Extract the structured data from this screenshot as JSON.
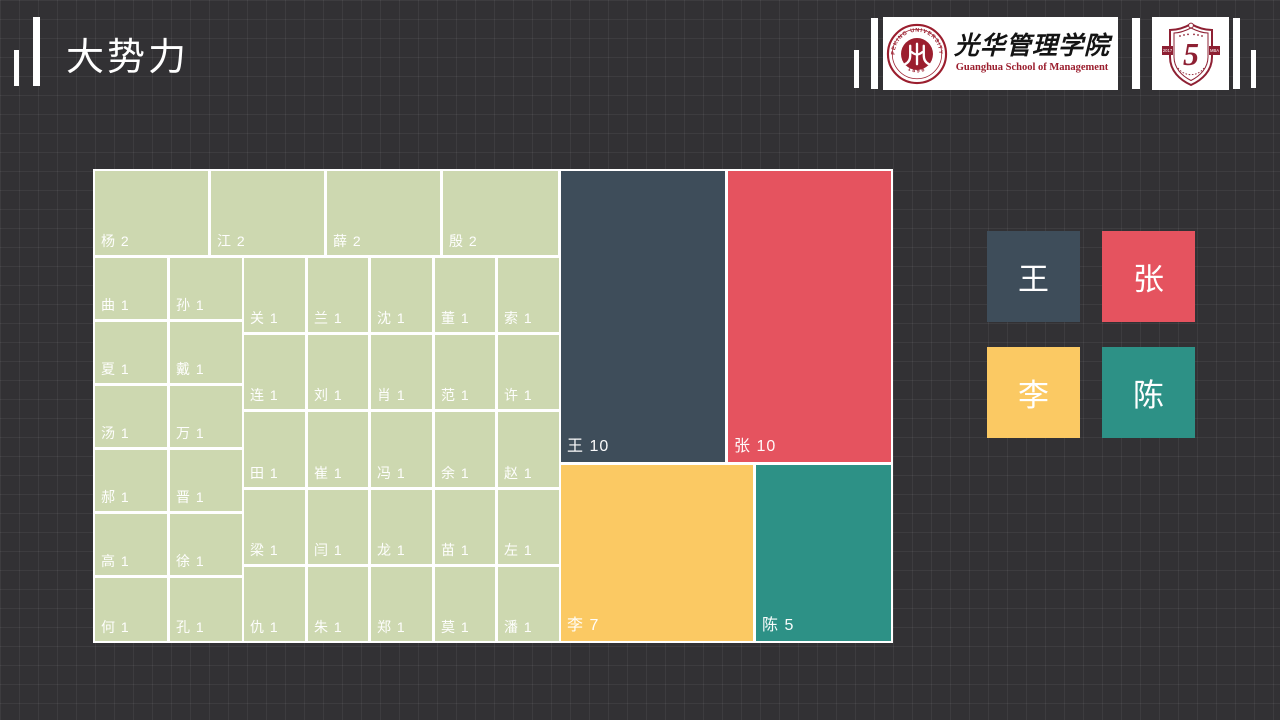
{
  "header": {
    "title": "大势力"
  },
  "logos": {
    "guanghua": {
      "name_cn": "光华管理学院",
      "name_en": "Guanghua School of Management",
      "seal_text_top": "PEKING UNIVERSITY",
      "seal_text_bottom": "1898"
    },
    "anniversary": {
      "number": "5",
      "year": "2017",
      "program": "MBA"
    }
  },
  "chart_data": {
    "type": "treemap",
    "title": "大势力",
    "description": "Surname frequency treemap; value = count of people per surname",
    "total": 77,
    "palette": {
      "green": "#cdd8b0",
      "dark": "#3e4d5a",
      "red": "#e5535f",
      "yellow": "#fbc963",
      "teal": "#2d9186"
    },
    "legend": [
      {
        "label": "王",
        "color": "dark"
      },
      {
        "label": "张",
        "color": "red"
      },
      {
        "label": "李",
        "color": "yellow"
      },
      {
        "label": "陈",
        "color": "teal"
      }
    ],
    "cells": [
      {
        "name": "王",
        "value": 10,
        "label": "王 10",
        "color": "dark",
        "x": 468,
        "y": 2,
        "w": 164,
        "h": 291
      },
      {
        "name": "张",
        "value": 10,
        "label": "张 10",
        "color": "red",
        "x": 635,
        "y": 2,
        "w": 163,
        "h": 291
      },
      {
        "name": "李",
        "value": 7,
        "label": "李 7",
        "color": "yellow",
        "x": 468,
        "y": 296,
        "w": 192,
        "h": 176
      },
      {
        "name": "陈",
        "value": 5,
        "label": "陈 5",
        "color": "teal",
        "x": 663,
        "y": 296,
        "w": 135,
        "h": 176
      },
      {
        "name": "杨",
        "value": 2,
        "label": "杨 2",
        "color": "green",
        "x": 2,
        "y": 2,
        "w": 113,
        "h": 84
      },
      {
        "name": "江",
        "value": 2,
        "label": "江 2",
        "color": "green",
        "x": 118,
        "y": 2,
        "w": 113,
        "h": 84
      },
      {
        "name": "薛",
        "value": 2,
        "label": "薛 2",
        "color": "green",
        "x": 234,
        "y": 2,
        "w": 113,
        "h": 84
      },
      {
        "name": "殷",
        "value": 2,
        "label": "殷 2",
        "color": "green",
        "x": 350,
        "y": 2,
        "w": 115,
        "h": 84
      },
      {
        "name": "曲",
        "value": 1,
        "label": "曲 1",
        "color": "green",
        "x": 2,
        "y": 89,
        "w": 72,
        "h": 61
      },
      {
        "name": "孙",
        "value": 1,
        "label": "孙 1",
        "color": "green",
        "x": 77,
        "y": 89,
        "w": 72,
        "h": 61
      },
      {
        "name": "夏",
        "value": 1,
        "label": "夏 1",
        "color": "green",
        "x": 2,
        "y": 153,
        "w": 72,
        "h": 61
      },
      {
        "name": "戴",
        "value": 1,
        "label": "戴 1",
        "color": "green",
        "x": 77,
        "y": 153,
        "w": 72,
        "h": 61
      },
      {
        "name": "汤",
        "value": 1,
        "label": "汤 1",
        "color": "green",
        "x": 2,
        "y": 217,
        "w": 72,
        "h": 61
      },
      {
        "name": "万",
        "value": 1,
        "label": "万 1",
        "color": "green",
        "x": 77,
        "y": 217,
        "w": 72,
        "h": 61
      },
      {
        "name": "郝",
        "value": 1,
        "label": "郝 1",
        "color": "green",
        "x": 2,
        "y": 281,
        "w": 72,
        "h": 61
      },
      {
        "name": "晋",
        "value": 1,
        "label": "晋 1",
        "color": "green",
        "x": 77,
        "y": 281,
        "w": 72,
        "h": 61
      },
      {
        "name": "高",
        "value": 1,
        "label": "高 1",
        "color": "green",
        "x": 2,
        "y": 345,
        "w": 72,
        "h": 61
      },
      {
        "name": "徐",
        "value": 1,
        "label": "徐 1",
        "color": "green",
        "x": 77,
        "y": 345,
        "w": 72,
        "h": 61
      },
      {
        "name": "何",
        "value": 1,
        "label": "何 1",
        "color": "green",
        "x": 2,
        "y": 409,
        "w": 72,
        "h": 63
      },
      {
        "name": "孔",
        "value": 1,
        "label": "孔 1",
        "color": "green",
        "x": 77,
        "y": 409,
        "w": 72,
        "h": 63
      },
      {
        "name": "关",
        "value": 1,
        "label": "关 1",
        "color": "green",
        "x": 151,
        "y": 89,
        "w": 61,
        "h": 74
      },
      {
        "name": "兰",
        "value": 1,
        "label": "兰 1",
        "color": "green",
        "x": 215,
        "y": 89,
        "w": 60,
        "h": 74
      },
      {
        "name": "沈",
        "value": 1,
        "label": "沈 1",
        "color": "green",
        "x": 278,
        "y": 89,
        "w": 61,
        "h": 74
      },
      {
        "name": "董",
        "value": 1,
        "label": "董 1",
        "color": "green",
        "x": 342,
        "y": 89,
        "w": 60,
        "h": 74
      },
      {
        "name": "索",
        "value": 1,
        "label": "索 1",
        "color": "green",
        "x": 405,
        "y": 89,
        "w": 61,
        "h": 74
      },
      {
        "name": "连",
        "value": 1,
        "label": "连 1",
        "color": "green",
        "x": 151,
        "y": 166,
        "w": 61,
        "h": 74
      },
      {
        "name": "刘",
        "value": 1,
        "label": "刘 1",
        "color": "green",
        "x": 215,
        "y": 166,
        "w": 60,
        "h": 74
      },
      {
        "name": "肖",
        "value": 1,
        "label": "肖 1",
        "color": "green",
        "x": 278,
        "y": 166,
        "w": 61,
        "h": 74
      },
      {
        "name": "范",
        "value": 1,
        "label": "范 1",
        "color": "green",
        "x": 342,
        "y": 166,
        "w": 60,
        "h": 74
      },
      {
        "name": "许",
        "value": 1,
        "label": "许 1",
        "color": "green",
        "x": 405,
        "y": 166,
        "w": 61,
        "h": 74
      },
      {
        "name": "田",
        "value": 1,
        "label": "田 1",
        "color": "green",
        "x": 151,
        "y": 243,
        "w": 61,
        "h": 75
      },
      {
        "name": "崔",
        "value": 1,
        "label": "崔 1",
        "color": "green",
        "x": 215,
        "y": 243,
        "w": 60,
        "h": 75
      },
      {
        "name": "冯",
        "value": 1,
        "label": "冯 1",
        "color": "green",
        "x": 278,
        "y": 243,
        "w": 61,
        "h": 75
      },
      {
        "name": "余",
        "value": 1,
        "label": "余 1",
        "color": "green",
        "x": 342,
        "y": 243,
        "w": 60,
        "h": 75
      },
      {
        "name": "赵",
        "value": 1,
        "label": "赵 1",
        "color": "green",
        "x": 405,
        "y": 243,
        "w": 61,
        "h": 75
      },
      {
        "name": "梁",
        "value": 1,
        "label": "梁 1",
        "color": "green",
        "x": 151,
        "y": 321,
        "w": 61,
        "h": 74
      },
      {
        "name": "闫",
        "value": 1,
        "label": "闫 1",
        "color": "green",
        "x": 215,
        "y": 321,
        "w": 60,
        "h": 74
      },
      {
        "name": "龙",
        "value": 1,
        "label": "龙 1",
        "color": "green",
        "x": 278,
        "y": 321,
        "w": 61,
        "h": 74
      },
      {
        "name": "苗",
        "value": 1,
        "label": "苗 1",
        "color": "green",
        "x": 342,
        "y": 321,
        "w": 60,
        "h": 74
      },
      {
        "name": "左",
        "value": 1,
        "label": "左 1",
        "color": "green",
        "x": 405,
        "y": 321,
        "w": 61,
        "h": 74
      },
      {
        "name": "仇",
        "value": 1,
        "label": "仇 1",
        "color": "green",
        "x": 151,
        "y": 398,
        "w": 61,
        "h": 74
      },
      {
        "name": "朱",
        "value": 1,
        "label": "朱 1",
        "color": "green",
        "x": 215,
        "y": 398,
        "w": 60,
        "h": 74
      },
      {
        "name": "郑",
        "value": 1,
        "label": "郑 1",
        "color": "green",
        "x": 278,
        "y": 398,
        "w": 61,
        "h": 74
      },
      {
        "name": "莫",
        "value": 1,
        "label": "莫 1",
        "color": "green",
        "x": 342,
        "y": 398,
        "w": 60,
        "h": 74
      },
      {
        "name": "潘",
        "value": 1,
        "label": "潘 1",
        "color": "green",
        "x": 405,
        "y": 398,
        "w": 61,
        "h": 74
      }
    ]
  }
}
